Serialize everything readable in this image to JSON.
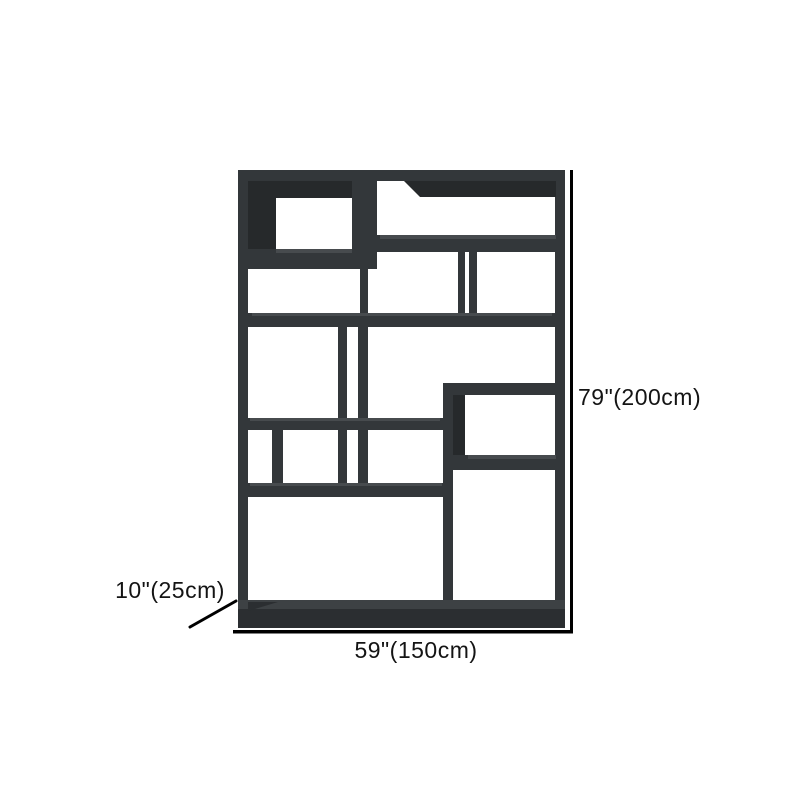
{
  "page": {
    "type": "product-dimension-diagram",
    "subject": "etagere-bookcase-shelf",
    "background_color": "#ffffff"
  },
  "dimensions": {
    "height_label": "79\"(200cm)",
    "width_label": "59\"(150cm)",
    "depth_label": "10\"(25cm)"
  },
  "colors": {
    "furniture_main": "#33373a",
    "furniture_shadow": "#26292b",
    "furniture_highlight": "#474b4e",
    "dimension_line": "#000000",
    "label_text": "#141414"
  }
}
